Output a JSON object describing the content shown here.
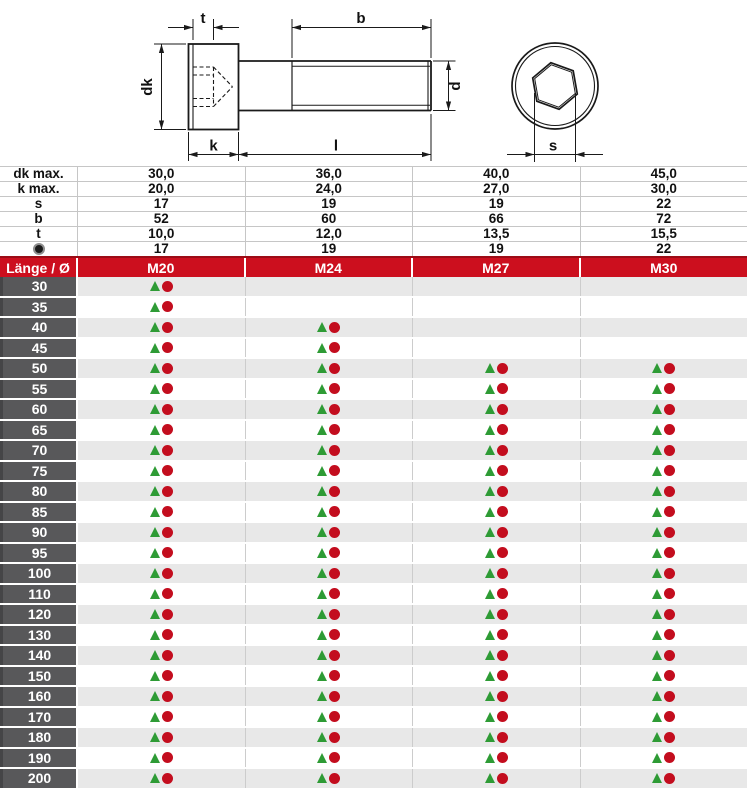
{
  "drawing": {
    "labels": {
      "t": "t",
      "b": "b",
      "dk": "dk",
      "k": "k",
      "l": "l",
      "d": "d",
      "s": "s"
    }
  },
  "spec_table": {
    "rows": [
      {
        "label": "dk max.",
        "values": [
          "30,0",
          "36,0",
          "40,0",
          "45,0"
        ]
      },
      {
        "label": "k max.",
        "values": [
          "20,0",
          "24,0",
          "27,0",
          "30,0"
        ]
      },
      {
        "label": "s",
        "values": [
          "17",
          "19",
          "19",
          "22"
        ]
      },
      {
        "label": "b",
        "values": [
          "52",
          "60",
          "66",
          "72"
        ]
      },
      {
        "label": "t",
        "values": [
          "10,0",
          "12,0",
          "13,5",
          "15,5"
        ]
      },
      {
        "label_icon": "dot-icon",
        "values": [
          "17",
          "19",
          "19",
          "22"
        ]
      }
    ]
  },
  "size_header": {
    "length_label": "Länge / Ø",
    "columns": [
      "M20",
      "M24",
      "M27",
      "M30"
    ]
  },
  "length_rows": [
    {
      "length": "30",
      "availability": [
        true,
        false,
        false,
        false
      ]
    },
    {
      "length": "35",
      "availability": [
        true,
        false,
        false,
        false
      ]
    },
    {
      "length": "40",
      "availability": [
        true,
        true,
        false,
        false
      ]
    },
    {
      "length": "45",
      "availability": [
        true,
        true,
        false,
        false
      ]
    },
    {
      "length": "50",
      "availability": [
        true,
        true,
        true,
        true
      ]
    },
    {
      "length": "55",
      "availability": [
        true,
        true,
        true,
        true
      ]
    },
    {
      "length": "60",
      "availability": [
        true,
        true,
        true,
        true
      ]
    },
    {
      "length": "65",
      "availability": [
        true,
        true,
        true,
        true
      ]
    },
    {
      "length": "70",
      "availability": [
        true,
        true,
        true,
        true
      ]
    },
    {
      "length": "75",
      "availability": [
        true,
        true,
        true,
        true
      ]
    },
    {
      "length": "80",
      "availability": [
        true,
        true,
        true,
        true
      ]
    },
    {
      "length": "85",
      "availability": [
        true,
        true,
        true,
        true
      ]
    },
    {
      "length": "90",
      "availability": [
        true,
        true,
        true,
        true
      ]
    },
    {
      "length": "95",
      "availability": [
        true,
        true,
        true,
        true
      ]
    },
    {
      "length": "100",
      "availability": [
        true,
        true,
        true,
        true
      ]
    },
    {
      "length": "110",
      "availability": [
        true,
        true,
        true,
        true
      ]
    },
    {
      "length": "120",
      "availability": [
        true,
        true,
        true,
        true
      ]
    },
    {
      "length": "130",
      "availability": [
        true,
        true,
        true,
        true
      ]
    },
    {
      "length": "140",
      "availability": [
        true,
        true,
        true,
        true
      ]
    },
    {
      "length": "150",
      "availability": [
        true,
        true,
        true,
        true
      ]
    },
    {
      "length": "160",
      "availability": [
        true,
        true,
        true,
        true
      ]
    },
    {
      "length": "170",
      "availability": [
        true,
        true,
        true,
        true
      ]
    },
    {
      "length": "180",
      "availability": [
        true,
        true,
        true,
        true
      ]
    },
    {
      "length": "190",
      "availability": [
        true,
        true,
        true,
        true
      ]
    },
    {
      "length": "200",
      "availability": [
        true,
        true,
        true,
        true
      ]
    }
  ],
  "icons": {
    "triangle": "▲",
    "circle": "●",
    "dot": "●"
  },
  "colors": {
    "accent_red": "#cc0f1e",
    "marker_green": "#2e9b35",
    "marker_red": "#c30d1e",
    "row_label_gray": "#58585a",
    "stripe_gray": "#e8e8e8"
  }
}
